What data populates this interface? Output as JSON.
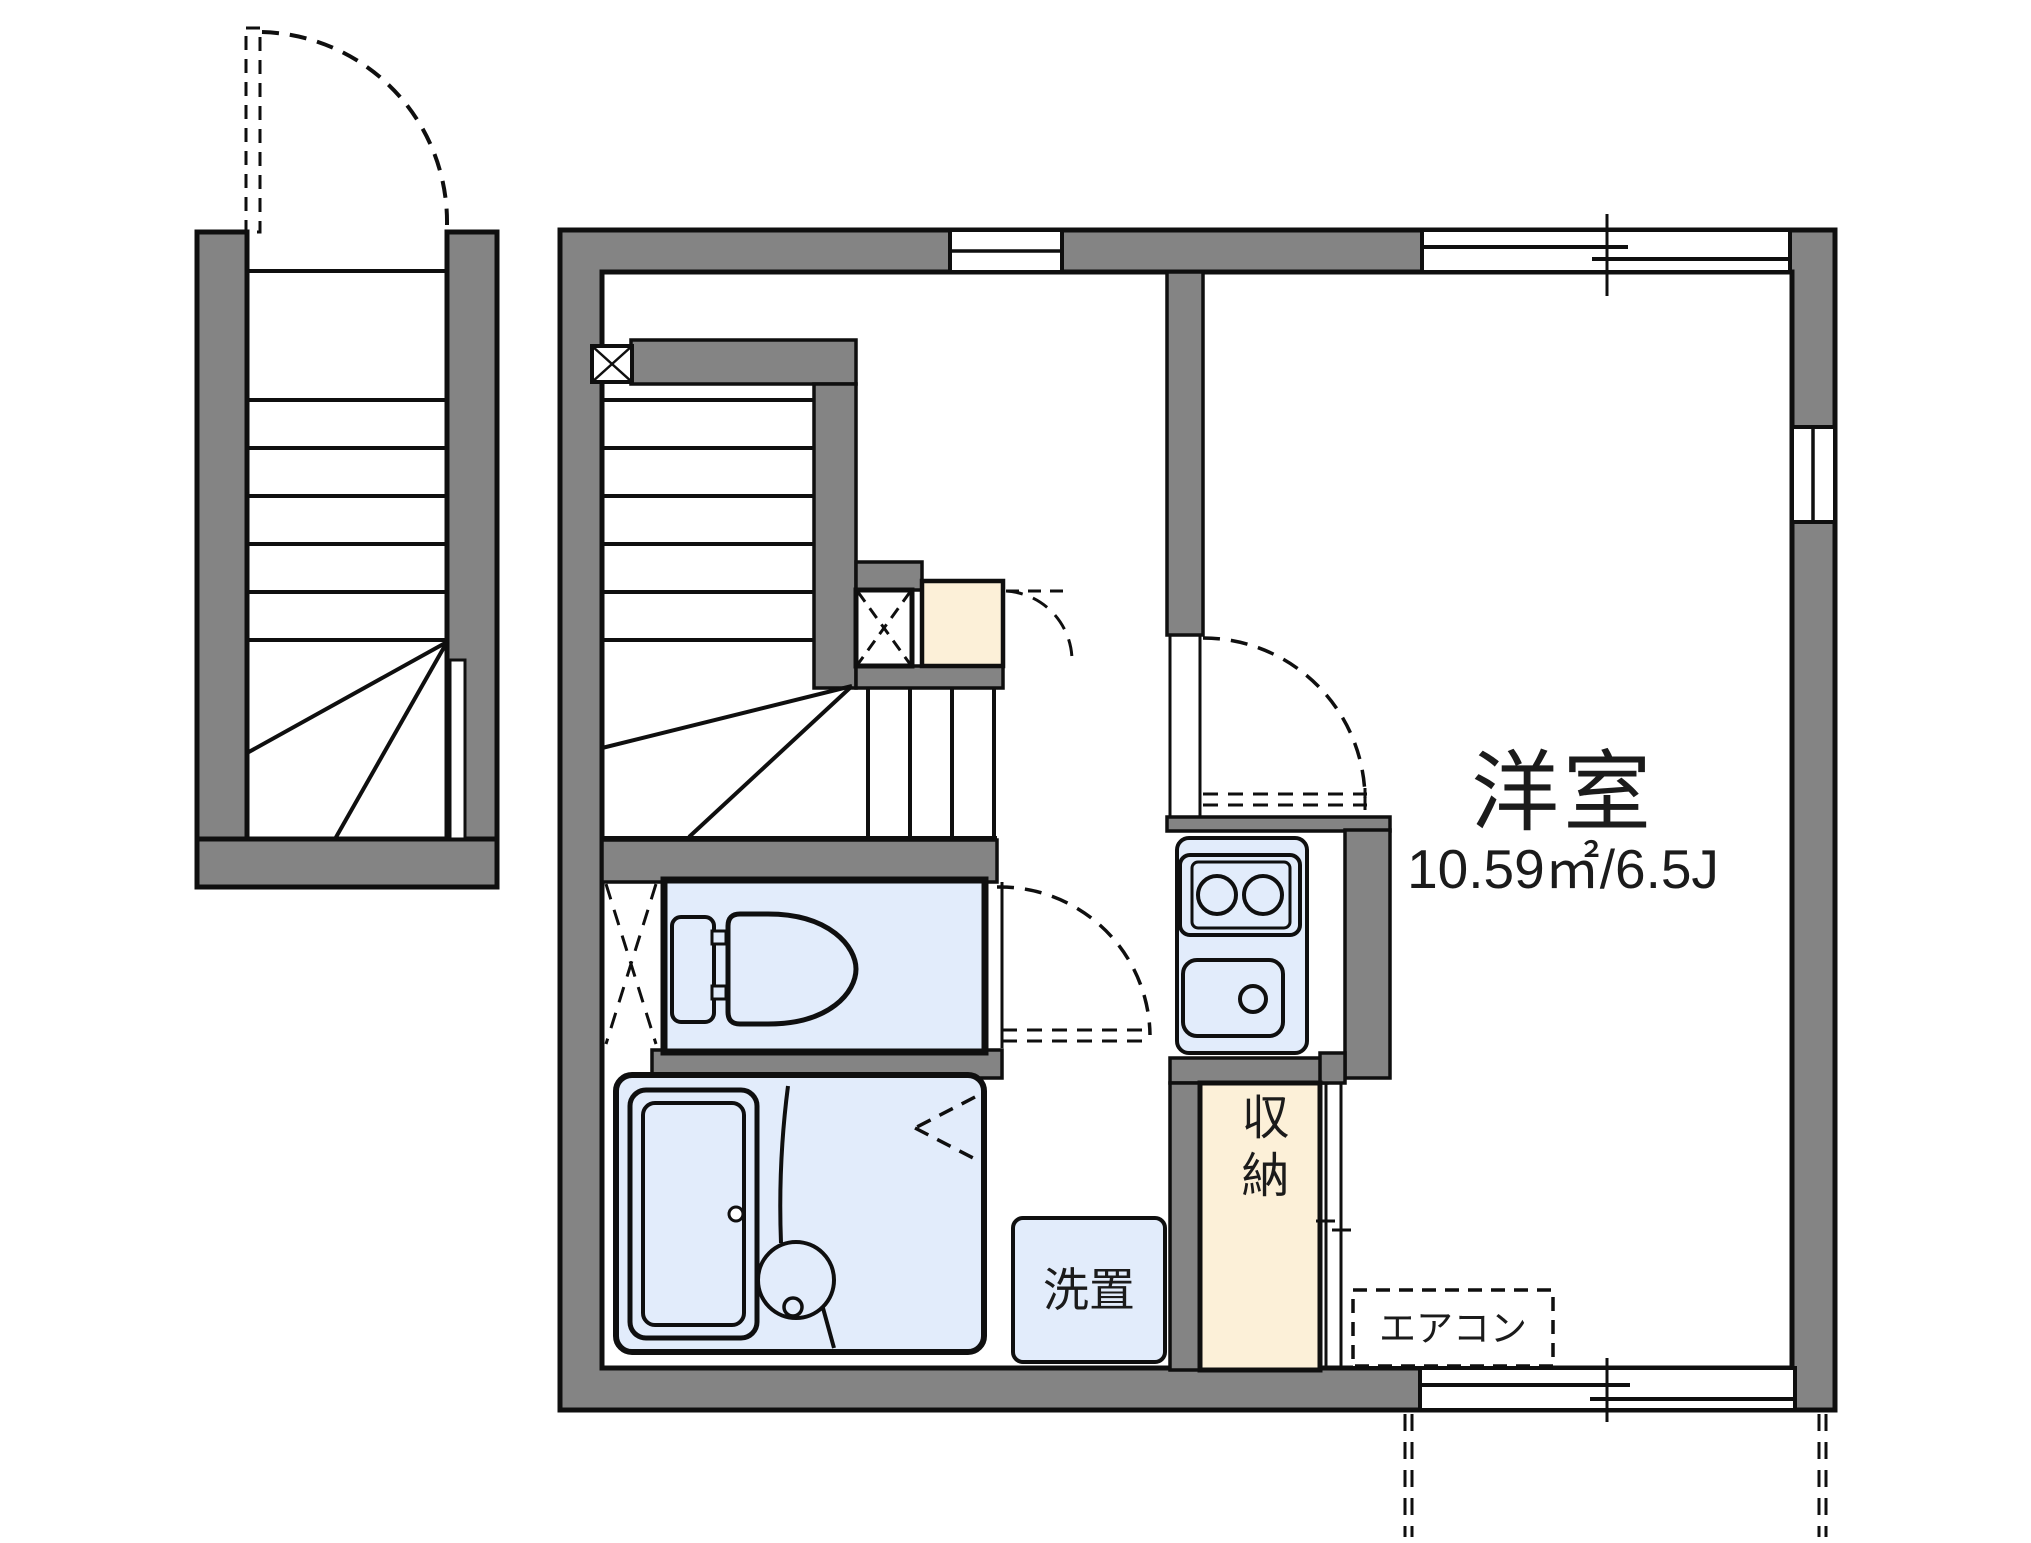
{
  "floorplan": {
    "title": "apartment-floorplan",
    "labels": {
      "room_name": "洋室",
      "room_size": "10.59㎡/6.5J",
      "washer": "洗置",
      "storage": "収納",
      "aircon": "エアコン"
    },
    "features": [
      "exterior-winder-staircase",
      "entrance-door-swing",
      "interior-winder-staircase",
      "toilet",
      "unit-bath-with-tub",
      "kitchen-two-burner-stove",
      "kitchen-sink",
      "storage-closet-sliding-door",
      "washer-space",
      "air-conditioner-position",
      "sliding-windows",
      "balcony-sliding-door"
    ],
    "colors": {
      "wall": "#848484",
      "line": "#0f0f0f",
      "water_area": "#e2ecfb",
      "storage_fill": "#fcf0d8",
      "background": "#ffffff"
    }
  }
}
